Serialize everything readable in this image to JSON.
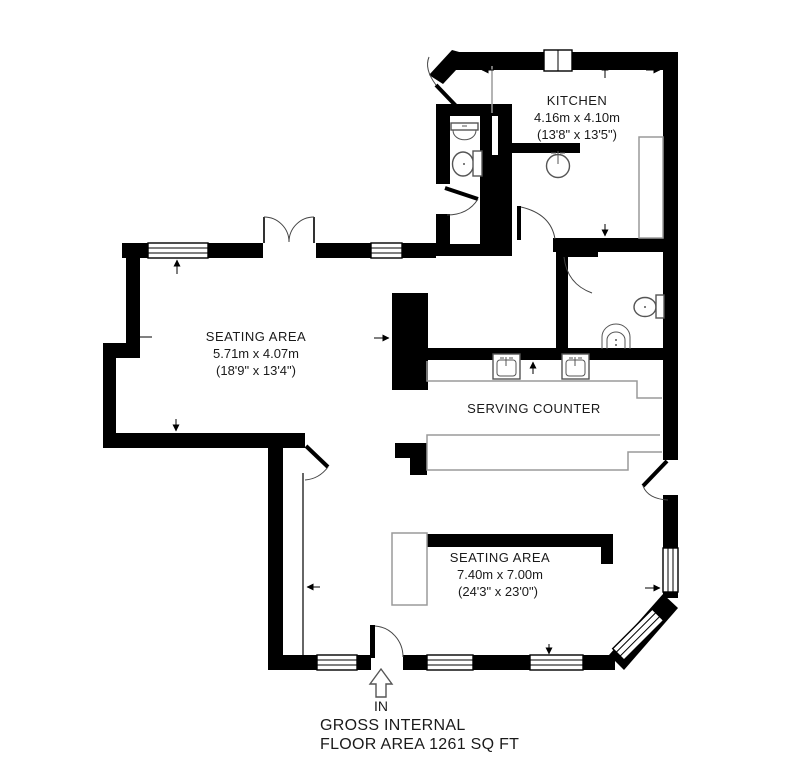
{
  "rooms": {
    "kitchen": {
      "name": "KITCHEN",
      "dim_metric": "4.16m x 4.10m",
      "dim_imperial": "(13'8\" x 13'5\")"
    },
    "seating_area_1": {
      "name": "SEATING AREA",
      "dim_metric": "5.71m x 4.07m",
      "dim_imperial": "(18'9\" x 13'4\")"
    },
    "serving_counter": {
      "name": "SERVING COUNTER"
    },
    "seating_area_2": {
      "name": "SEATING AREA",
      "dim_metric": "7.40m x 7.00m",
      "dim_imperial": "(24'3\" x 23'0\")"
    }
  },
  "entrance": {
    "label": "IN"
  },
  "footer": {
    "line1": "GROSS INTERNAL",
    "line2": "FLOOR AREA 1261 SQ FT"
  },
  "colors": {
    "wall": "#000000",
    "fixture": "#555555",
    "counter": "#9a9a9a",
    "background": "#ffffff"
  }
}
